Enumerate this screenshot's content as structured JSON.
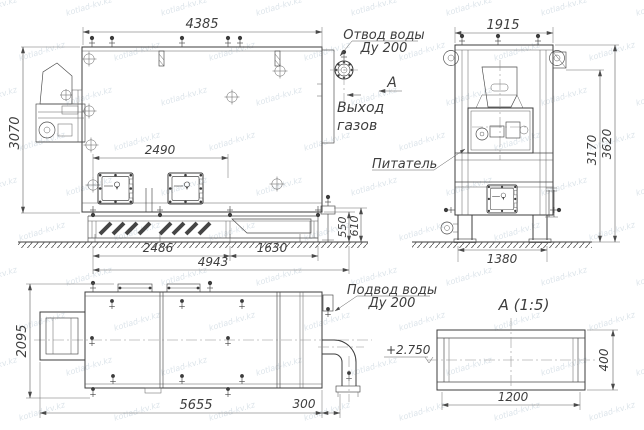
{
  "watermark": {
    "text": "kotlad-kv.kz"
  },
  "views": {
    "side": {
      "dim_top": "4385",
      "dim_height": "3070",
      "dim_doors": "2490",
      "dim_bottom_left": "2486",
      "dim_bottom_right": "1630",
      "dim_bottom_total": "4943",
      "dim_base_inner": "550",
      "dim_base_outer": "610",
      "label_outlet_line1": "Отвод воды",
      "label_outlet_line2": "Ду 200",
      "label_gas_line1": "Выход",
      "label_gas_line2": "газов",
      "section_mark": "А"
    },
    "front": {
      "dim_top": "1915",
      "dim_height_inner": "3170",
      "dim_height_outer": "3620",
      "dim_bottom": "1380",
      "label_feeder": "Питатель"
    },
    "top": {
      "dim_height": "2095",
      "dim_length": "5655",
      "dim_pipe": "300",
      "label_inlet_line1": "Подвод воды",
      "label_inlet_line2": "Ду 200",
      "elevation": "+2.750"
    },
    "section_a": {
      "title": "А  (1:5)",
      "dim_width": "1200",
      "dim_height": "400"
    }
  }
}
